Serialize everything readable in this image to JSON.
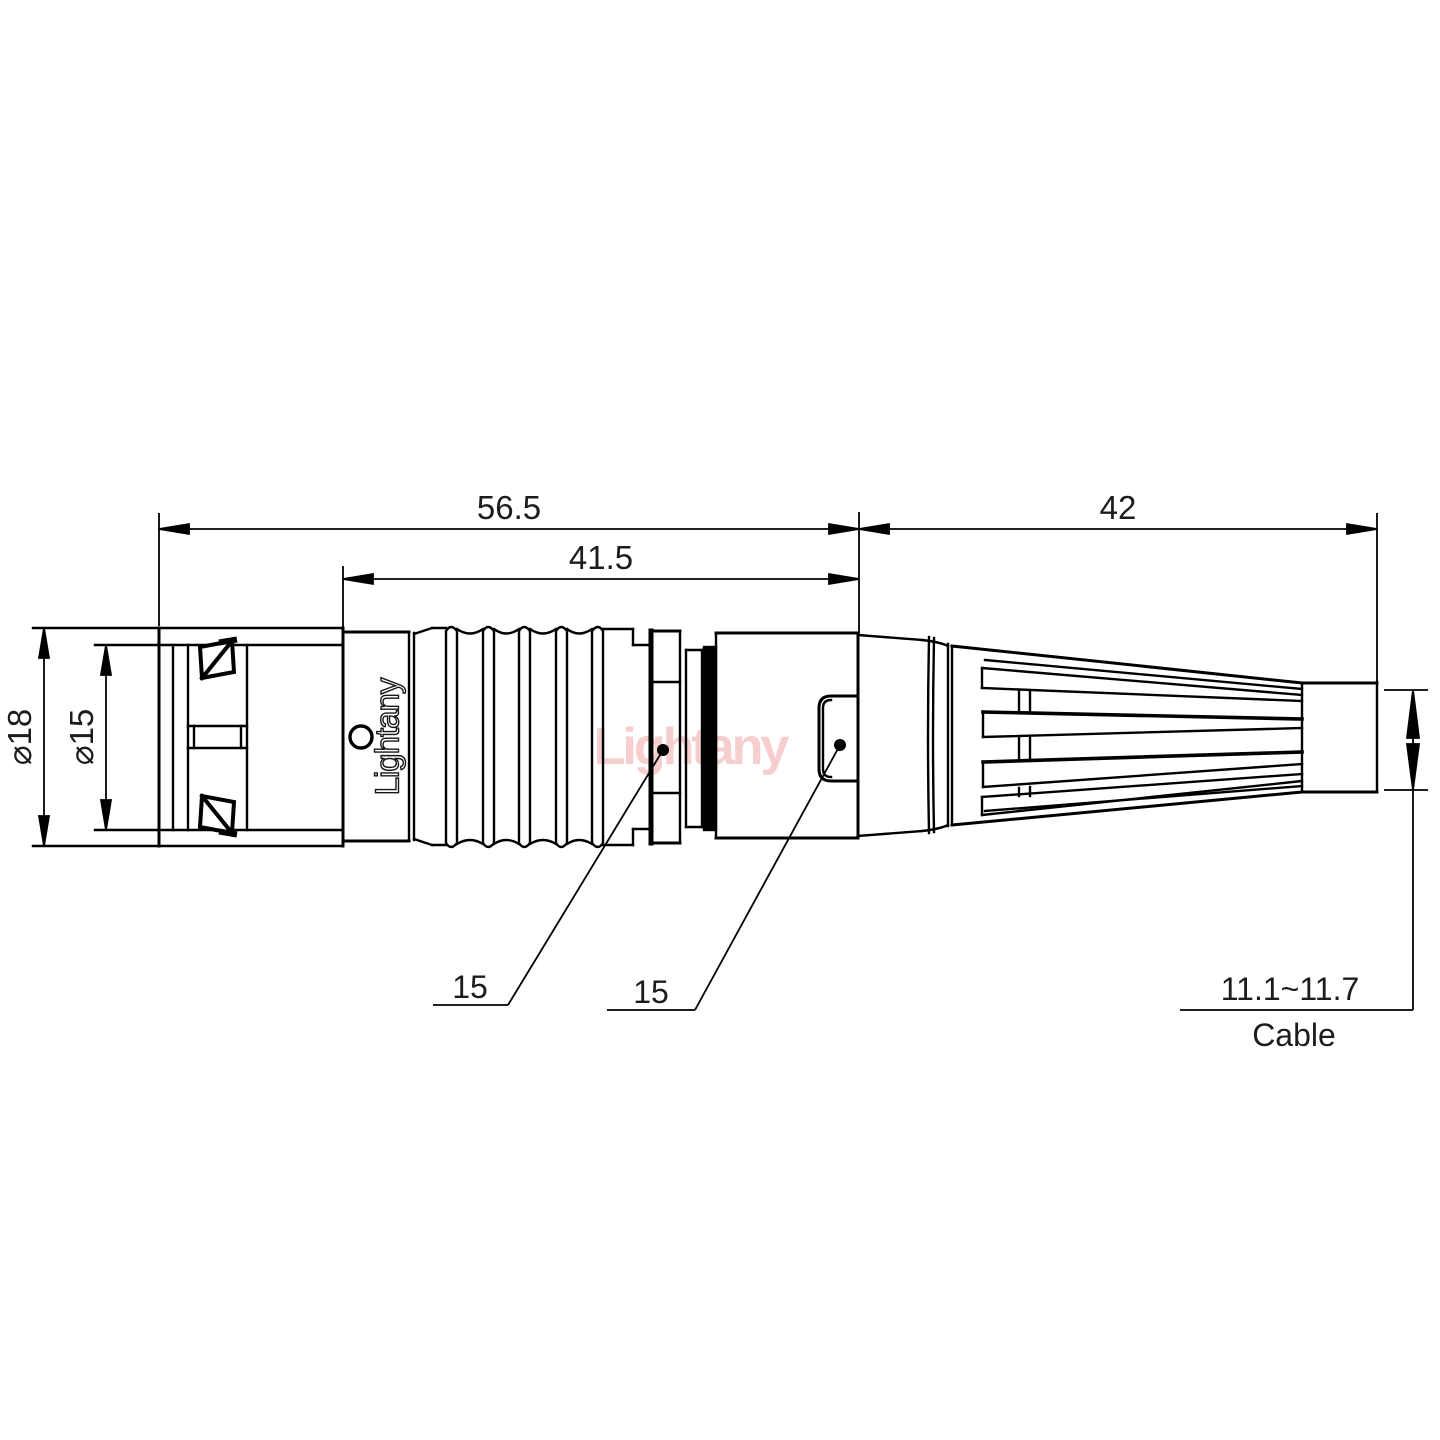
{
  "drawing": {
    "title_hint": "connector technical drawing",
    "watermark": "Lightany",
    "logo": "Lightany",
    "dimensions": {
      "overall_length": "56.5",
      "body_length": "41.5",
      "boot_length": "42",
      "outer_diameter": "⌀18",
      "inner_diameter": "⌀15",
      "leader_left_value": "15",
      "leader_right_value": "15",
      "cable_range": "11.1~11.7",
      "cable_label": "Cable"
    },
    "colors": {
      "line": "#000000",
      "watermark_pink": "#f3bebe",
      "background": "#ffffff"
    }
  }
}
